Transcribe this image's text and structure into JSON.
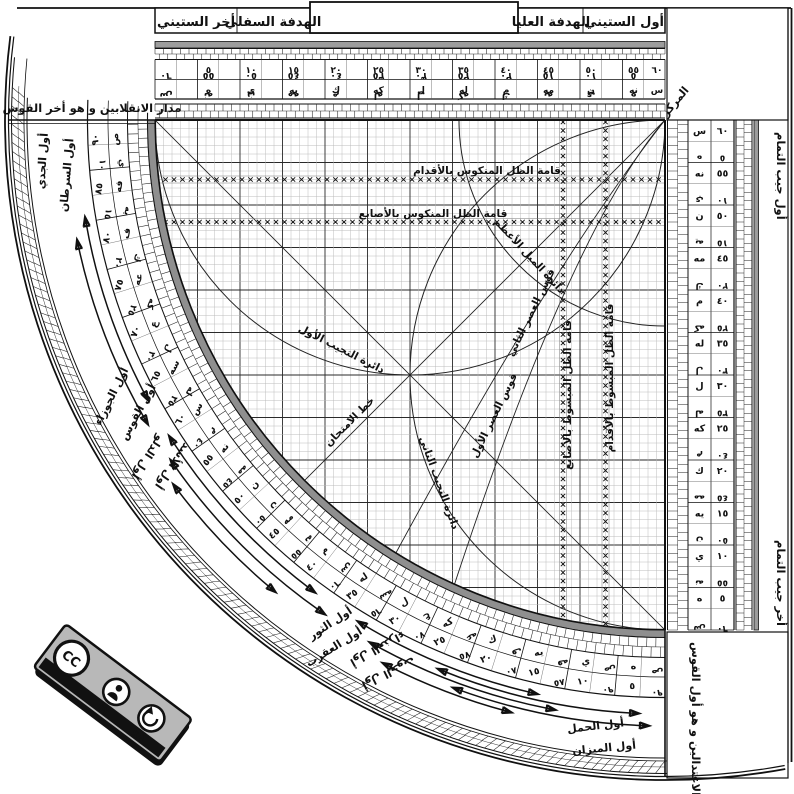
{
  "header": {
    "cells": [
      "أخر الستيني",
      "الهدفة السفلي",
      "الهدفة العليا",
      "أول الستيني"
    ]
  },
  "labels": {
    "markaz": "المركز",
    "madar_top_left": "مدار الانقلابين و هو أخر القوس",
    "madar_bottom_right": "مدار الاعتدالين و هو أول القوس",
    "jayb_top": "أول جيب التمام",
    "jayb_bottom": "أخر جيب التمام"
  },
  "scales": {
    "step": 5,
    "max": 60,
    "arc_max": 90,
    "abjad": [
      "ه",
      "ي",
      "يه",
      "ك",
      "كه",
      "ل",
      "له",
      "م",
      "مه",
      "ن",
      "نه",
      "س",
      "سه",
      "ع",
      "عه",
      "ف",
      "فه",
      "ص"
    ],
    "numerals": [
      "٥",
      "١٠",
      "١٥",
      "٢٠",
      "٢٥",
      "٣٠",
      "٣٥",
      "٤٠",
      "٤٥",
      "٥٠",
      "٥٥",
      "٦٠",
      "٦٥",
      "٧٠",
      "٧٥",
      "٨٠",
      "٨٥",
      "٩٠"
    ]
  },
  "grid_curve_labels": [
    {
      "id": "mankus-aqdam",
      "text": "قامة الظل المنكوس بالأقدام",
      "x": 487,
      "y": 174,
      "rot": 0
    },
    {
      "id": "mankus-asabi",
      "text": "قامة الظل المنكوس بالأصابع",
      "x": 433,
      "y": 217,
      "rot": 0
    },
    {
      "id": "mayl-azam",
      "text": "دائرة الميل الأعظم",
      "x": 527,
      "y": 258,
      "rot": 47
    },
    {
      "id": "asr-thani",
      "text": "قوس العصر الثاني",
      "x": 534,
      "y": 314,
      "rot": -64
    },
    {
      "id": "asr-awwal",
      "text": "قوس العصر الأول",
      "x": 497,
      "y": 417,
      "rot": -64
    },
    {
      "id": "mabsut-asabi",
      "text": "قامة الظل المبسوط بالأصابع",
      "x": 571,
      "y": 395,
      "rot": -90
    },
    {
      "id": "mabsut-aqdam",
      "text": "قامة الظل المبسوط بالأقدام",
      "x": 613,
      "y": 378,
      "rot": -90
    },
    {
      "id": "tajyib-awwal",
      "text": "دائرة التجيب الأول",
      "x": 340,
      "y": 352,
      "rot": 27
    },
    {
      "id": "imtihan",
      "text": "خط الامتحان",
      "x": 352,
      "y": 424,
      "rot": -45
    },
    {
      "id": "tajyib-thani",
      "text": "دائرة التجيب الثاني",
      "x": 436,
      "y": 484,
      "rot": 70
    }
  ],
  "zodiac_labels": [
    {
      "text": "أول الجدي",
      "theta": 86.5,
      "r": 620,
      "flip": false
    },
    {
      "text": "أول السرطان",
      "theta": 85,
      "r": 597,
      "flip": false
    },
    {
      "text": "أول الجوزاء",
      "theta": 63.5,
      "r": 615,
      "flip": false
    },
    {
      "text": "أول القوس",
      "theta": 61,
      "r": 599,
      "flip": false
    },
    {
      "text": "أول الدلو",
      "theta": 57.5,
      "r": 617,
      "flip": true
    },
    {
      "text": "أول الأسد",
      "theta": 55.5,
      "r": 601,
      "flip": true
    },
    {
      "text": "أول الثور",
      "theta": 33.5,
      "r": 603,
      "flip": false
    },
    {
      "text": "أول العقرب",
      "theta": 32,
      "r": 621,
      "flip": false
    },
    {
      "text": "أول العذراء",
      "theta": 29,
      "r": 597,
      "flip": true
    },
    {
      "text": "أول الحوت",
      "theta": 27,
      "r": 613,
      "flip": true
    },
    {
      "text": "أول الحمل",
      "theta": 6.5,
      "r": 610,
      "flip": false
    },
    {
      "text": "أول الميزان",
      "theta": 5.5,
      "r": 631,
      "flip": false
    }
  ],
  "cc_badge": {
    "cc": "CC",
    "by": "BY",
    "sa": "SA"
  },
  "colors": {
    "ink": "#1a1a1a",
    "gray_band": "#9c9c9c",
    "rim": "#8f8f8f",
    "grid_fine": "#b7b7b7",
    "grid_major": "#2a2a2a",
    "badge_gray": "#b8b8b8"
  }
}
